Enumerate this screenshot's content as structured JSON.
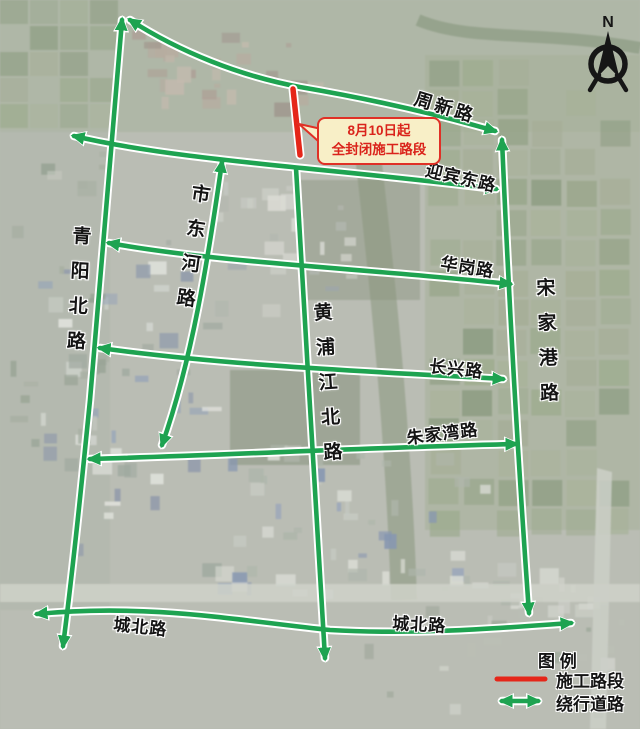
{
  "colors": {
    "detour_green": "#1ea351",
    "construction_red": "#e52619",
    "casing_white": "#ffffff",
    "label_color": "#141414",
    "callout_bg": "#f8efc7",
    "callout_border": "#e03026",
    "callout_text": "#da231b",
    "compass_color": "#161616"
  },
  "roads": {
    "zhouxin": "周新路",
    "yingbin": "迎宾东路",
    "huagang": "华岗路",
    "changxing": "长兴路",
    "zhujiawan": "朱家湾路",
    "chengbei_west": "城北路",
    "chengbei_east": "城北路",
    "qingyang": "青阳北路",
    "shidong": "市东河路",
    "huangpu": "黄浦江北路",
    "songjia": "宋家港路"
  },
  "callout": {
    "line1": "8月10日起",
    "line2": "全封闭施工路段"
  },
  "legend": {
    "title": "图 例",
    "items": [
      {
        "label": "施工路段",
        "swatch": "construction-line"
      },
      {
        "label": "绕行道路",
        "swatch": "detour-arrow"
      }
    ]
  },
  "compass": {
    "label": "N"
  }
}
